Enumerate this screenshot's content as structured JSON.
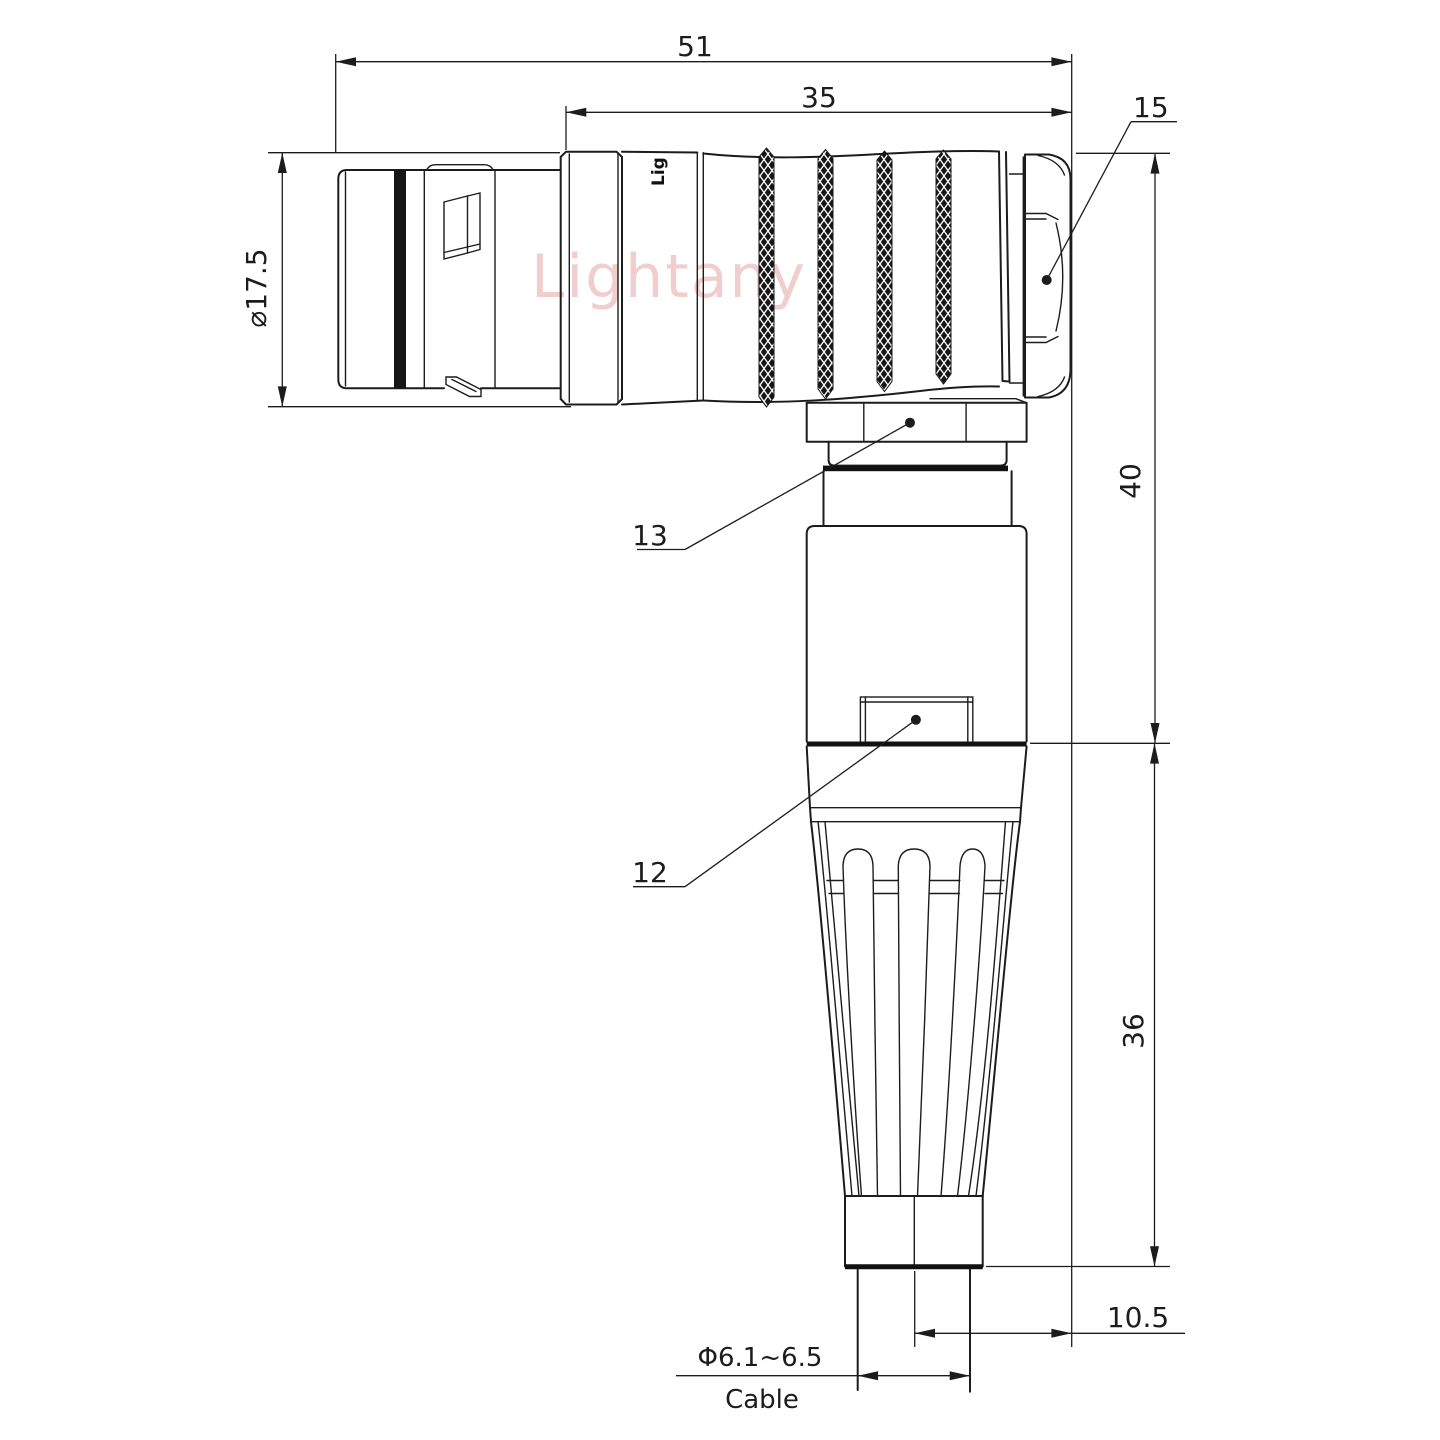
{
  "title": "Right-angle connector dimension drawing",
  "dimensions": {
    "overall_length": "51",
    "shell_length": "35",
    "hex_nut_callout": "15",
    "body_diameter": "⌀17.5",
    "elbow_height": "40",
    "boot_length": "36",
    "cable_offset": "10.5",
    "cable_diameter": "Φ6.1~6.5",
    "cable_label": "Cable"
  },
  "callouts": {
    "coupling_nut": "13",
    "latch_window": "12"
  },
  "watermark": {
    "text": "Lightany",
    "color": "#e59f9f"
  },
  "shell_marking": "Lig",
  "line_color": "#1c1c1c",
  "background_color": "#ffffff"
}
